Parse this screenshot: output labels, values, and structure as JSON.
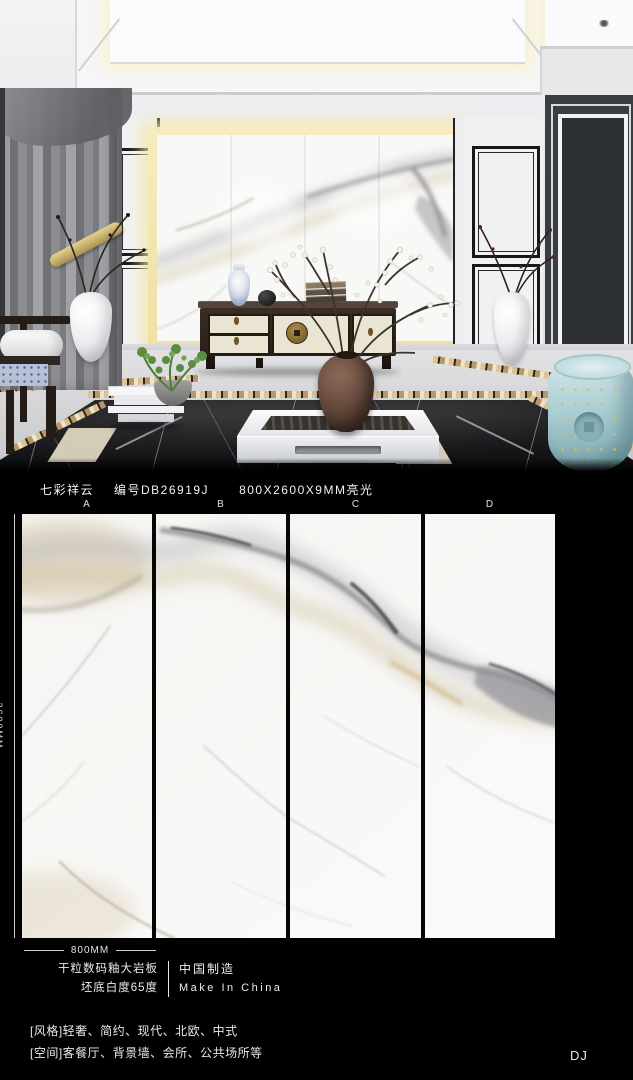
{
  "header": {
    "product_name": "七彩祥云",
    "product_code": "编号DB26919J",
    "spec": "800X2600X9MM亮光"
  },
  "panels": {
    "labels": [
      "A",
      "B",
      "C",
      "D"
    ]
  },
  "dimensions": {
    "height": "2600MM",
    "width": "800MM"
  },
  "product_info": {
    "material": "干粒数码釉大岩板",
    "whiteness": "坯底白度65度",
    "origin_cn": "中国制造",
    "origin_en": "Make In China"
  },
  "footer": {
    "style_line": "[风格]轻奢、简约、现代、北欧、中式",
    "space_line": "[空间]客餐厅、背景墙、会所、公共场所等",
    "watermark": "DJ"
  },
  "colors": {
    "background": "#000000",
    "backlight_glow": "#f3e8b6",
    "marble_vein_gray": "#8f8f94",
    "marble_vein_tan": "#cdbb93",
    "stool_teal": "#a9ced3",
    "black_marble_floor": "#101013"
  }
}
